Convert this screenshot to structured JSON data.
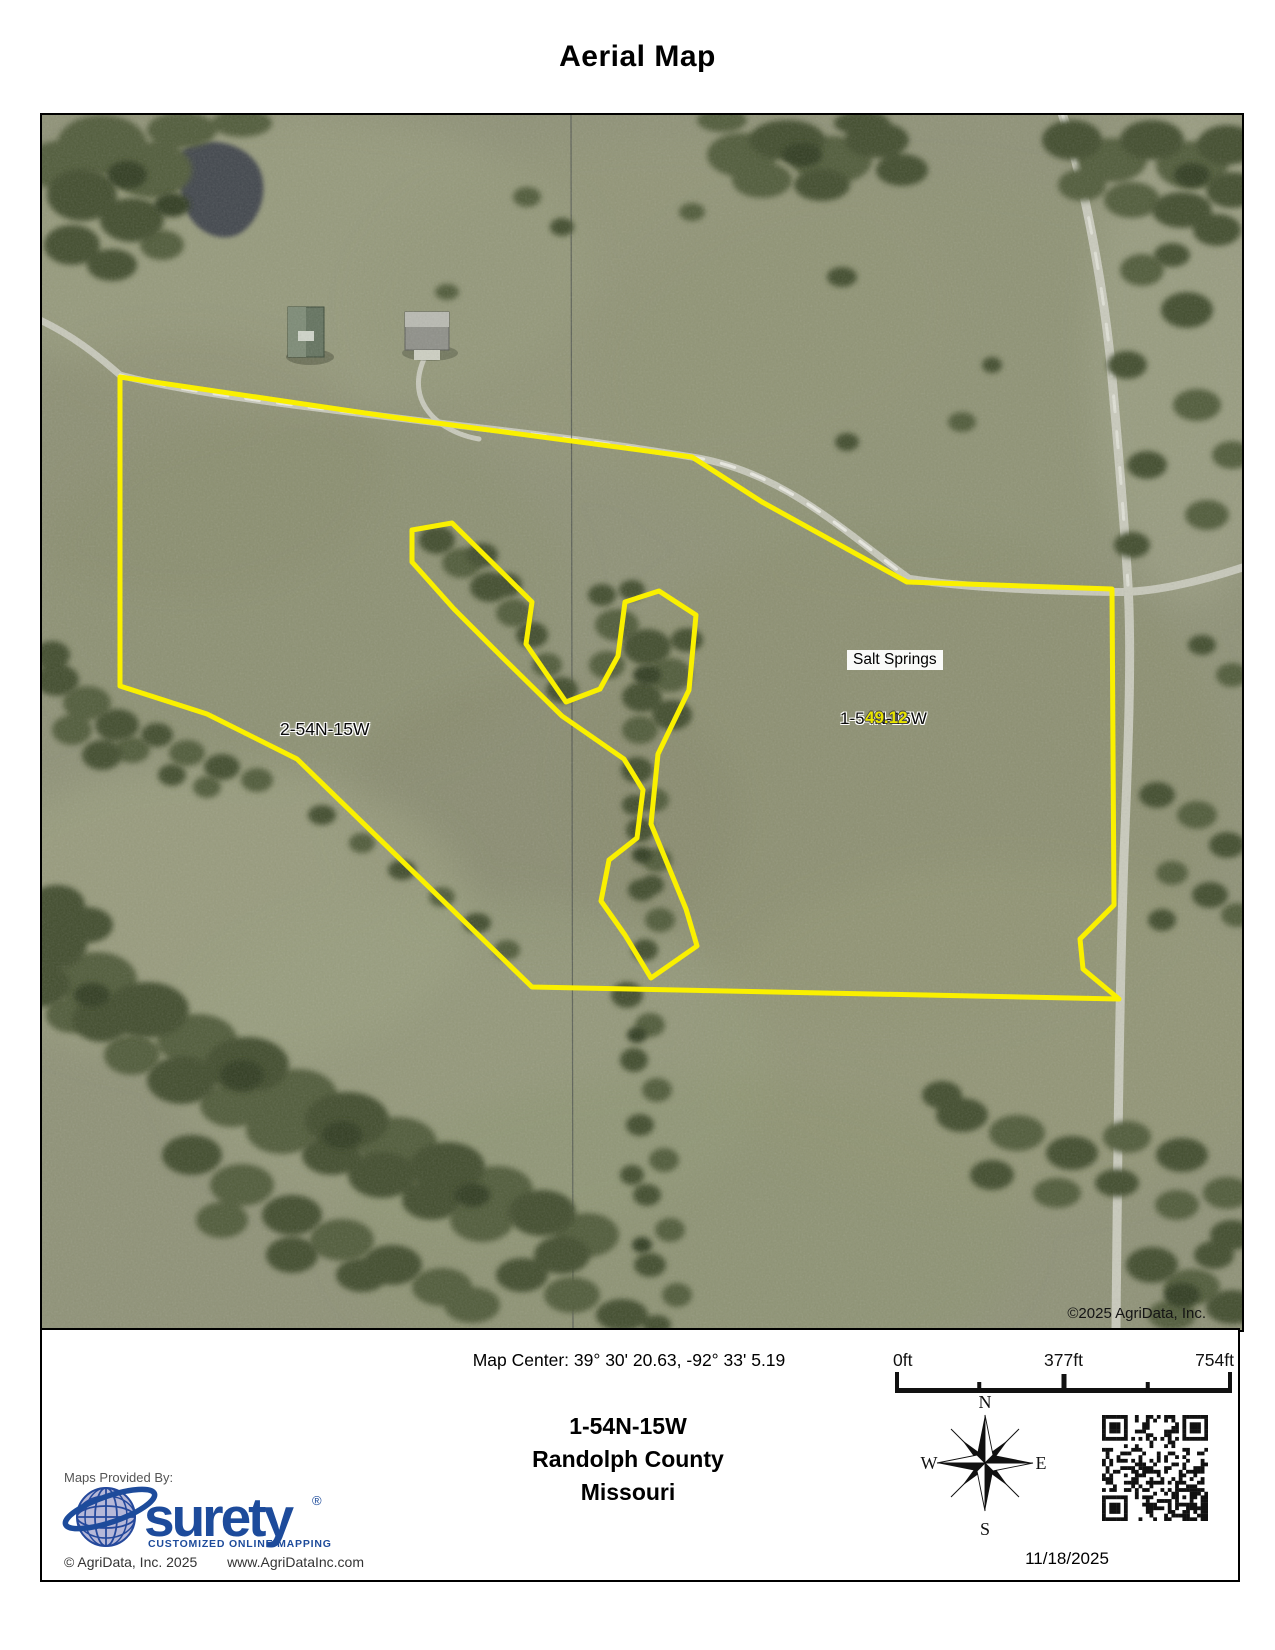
{
  "title": "Aerial Map",
  "map": {
    "labels": {
      "section_left": "2-54N-15W",
      "place": "Salt Springs",
      "section_right": "1-54N-15W",
      "acreage": "49.12",
      "copyright": "©2025 AgriData, Inc."
    },
    "colors": {
      "boundary": "#FAF000",
      "acreage_text": "#E8E400"
    },
    "boundary": {
      "outer": [
        [
          78,
          262
        ],
        [
          350,
          302
        ],
        [
          650,
          342
        ],
        [
          720,
          387
        ],
        [
          865,
          467
        ],
        [
          1070,
          474
        ],
        [
          1072,
          790
        ],
        [
          1038,
          824
        ],
        [
          1041,
          854
        ],
        [
          1077,
          884
        ],
        [
          490,
          872
        ],
        [
          255,
          644
        ],
        [
          165,
          599
        ],
        [
          78,
          571
        ]
      ],
      "inner": [
        [
          370,
          415
        ],
        [
          410,
          408
        ],
        [
          490,
          487
        ],
        [
          484,
          529
        ],
        [
          524,
          587
        ],
        [
          558,
          574
        ],
        [
          576,
          541
        ],
        [
          583,
          487
        ],
        [
          617,
          476
        ],
        [
          654,
          500
        ],
        [
          647,
          575
        ],
        [
          616,
          639
        ],
        [
          609,
          709
        ],
        [
          644,
          794
        ],
        [
          655,
          831
        ],
        [
          609,
          863
        ],
        [
          583,
          820
        ],
        [
          559,
          786
        ],
        [
          567,
          745
        ],
        [
          595,
          723
        ],
        [
          601,
          675
        ],
        [
          582,
          644
        ],
        [
          520,
          601
        ],
        [
          460,
          542
        ],
        [
          412,
          494
        ],
        [
          370,
          447
        ]
      ]
    }
  },
  "footer": {
    "map_center": "Map Center: 39° 30' 20.63,  -92° 33' 5.19",
    "section": "1-54N-15W",
    "county": "Randolph County",
    "state": "Missouri",
    "scale": {
      "start": "0ft",
      "mid": "377ft",
      "end": "754ft"
    },
    "compass": {
      "n": "N",
      "e": "E",
      "s": "S",
      "w": "W"
    },
    "date": "11/18/2025",
    "logo": {
      "provided_by": "Maps Provided By:",
      "brand": "surety",
      "registered": "®",
      "tagline": "CUSTOMIZED ONLINE MAPPING",
      "copyright": "© AgriData, Inc. 2025",
      "website": "www.AgriDataInc.com"
    }
  }
}
